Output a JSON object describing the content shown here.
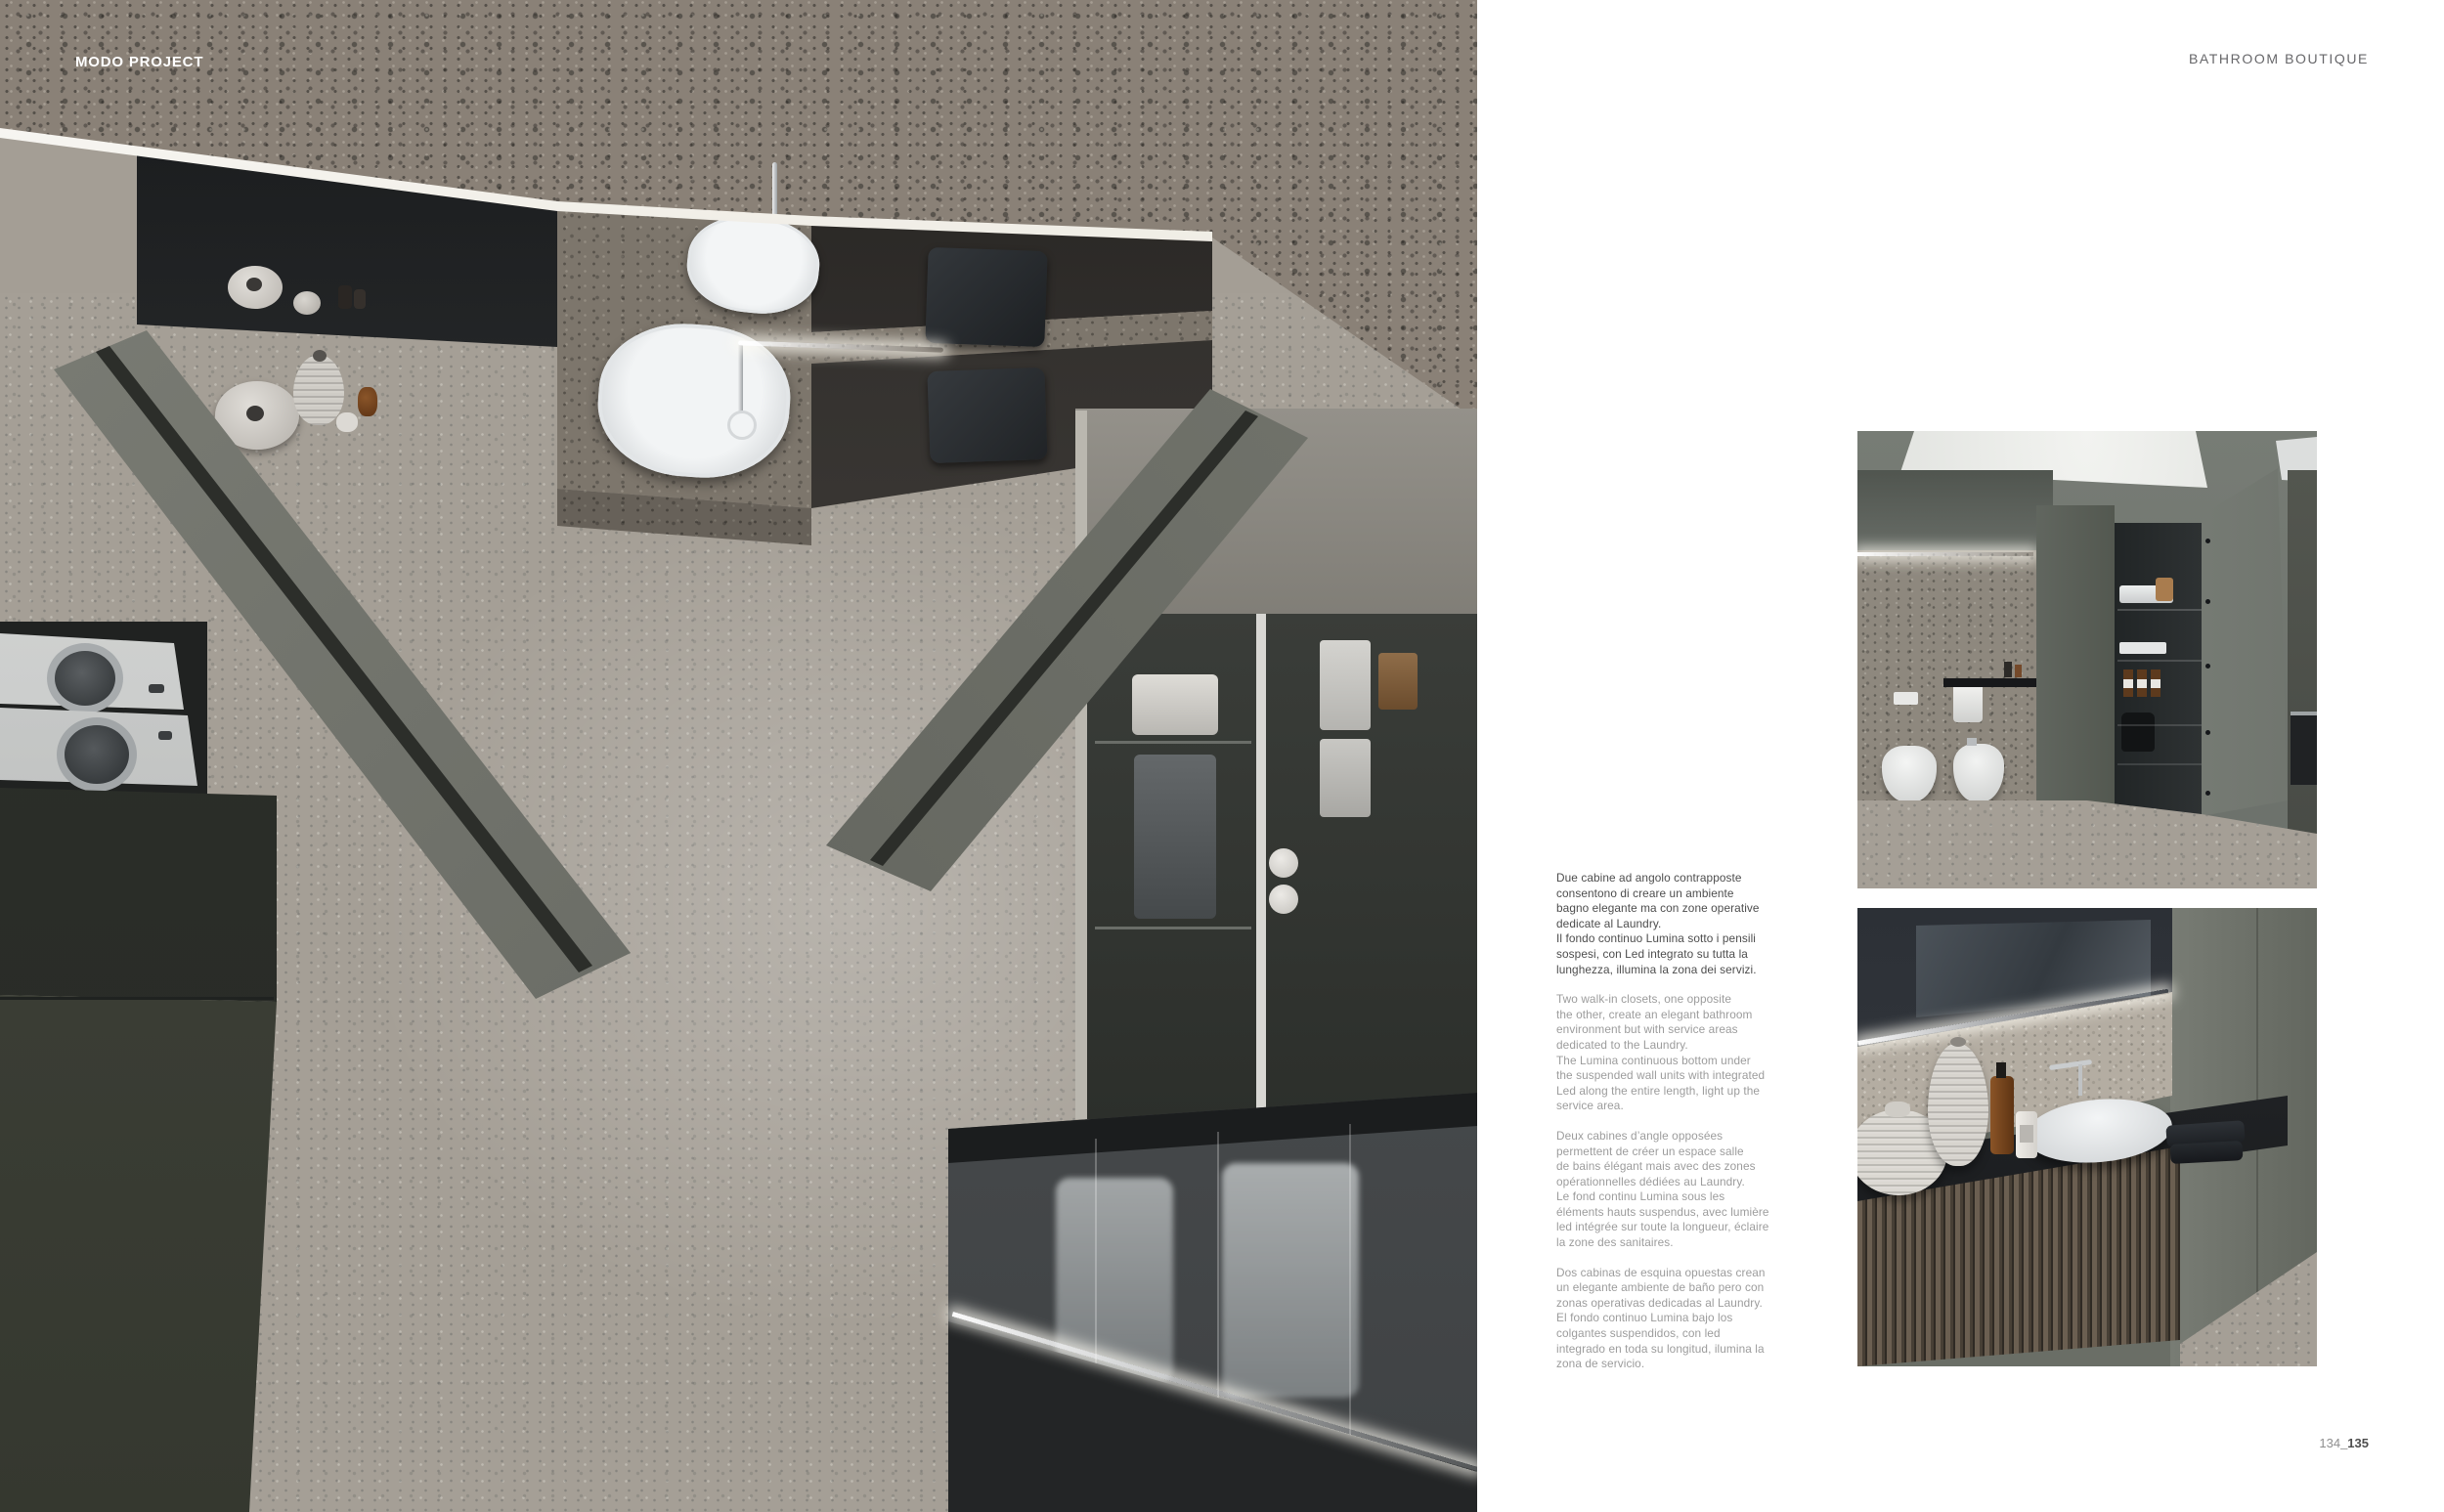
{
  "page": {
    "left_header": "MODO PROJECT",
    "right_header": "BATHROOM BOUTIQUE",
    "page_number": {
      "regular": "134",
      "bold": "_135"
    }
  },
  "paragraphs": [
    {
      "lang": "it",
      "text": "Due cabine ad angolo contrapposte\nconsentono di creare un ambiente\nbagno elegante ma con zone operative\ndedicate al Laundry.\nIl fondo continuo Lumina sotto i pensili\nsospesi, con Led integrato su tutta la\nlunghezza, illumina la zona dei servizi."
    },
    {
      "lang": "en",
      "text": "Two walk-in closets, one opposite\nthe other, create an elegant bathroom\nenvironment but with service areas\ndedicated to the Laundry.\nThe Lumina continuous bottom under\nthe suspended wall units with integrated\nLed along the entire length, light up the\nservice area."
    },
    {
      "lang": "fr",
      "text": "Deux cabines d’angle opposées\npermettent de créer un espace salle\nde bains élégant mais avec des zones\nopérationnelles dédiées au Laundry.\nLe fond continu Lumina sous les\néléments hauts suspendus, avec lumière\nled intégrée sur toute la longueur, éclaire\nla zone des sanitaires."
    },
    {
      "lang": "es",
      "text": "Dos cabinas de esquina opuestas crean\nun elegante ambiente de baño pero con\nzonas operativas dedicadas al Laundry.\nEl fondo continuo Lumina bajo los\ncolgantes suspendidos, con led\nintegrado en toda su longitud, ilumina la\nzona de servicio."
    }
  ],
  "colors": {
    "page_background": "#ffffff",
    "led_accent": "#f7f4ec",
    "terrazzo": "#8a8177",
    "cabinet_green_gray": "#6e736d",
    "text_dark": "#4d4d4d",
    "text_gray": "#9c9c9c"
  }
}
